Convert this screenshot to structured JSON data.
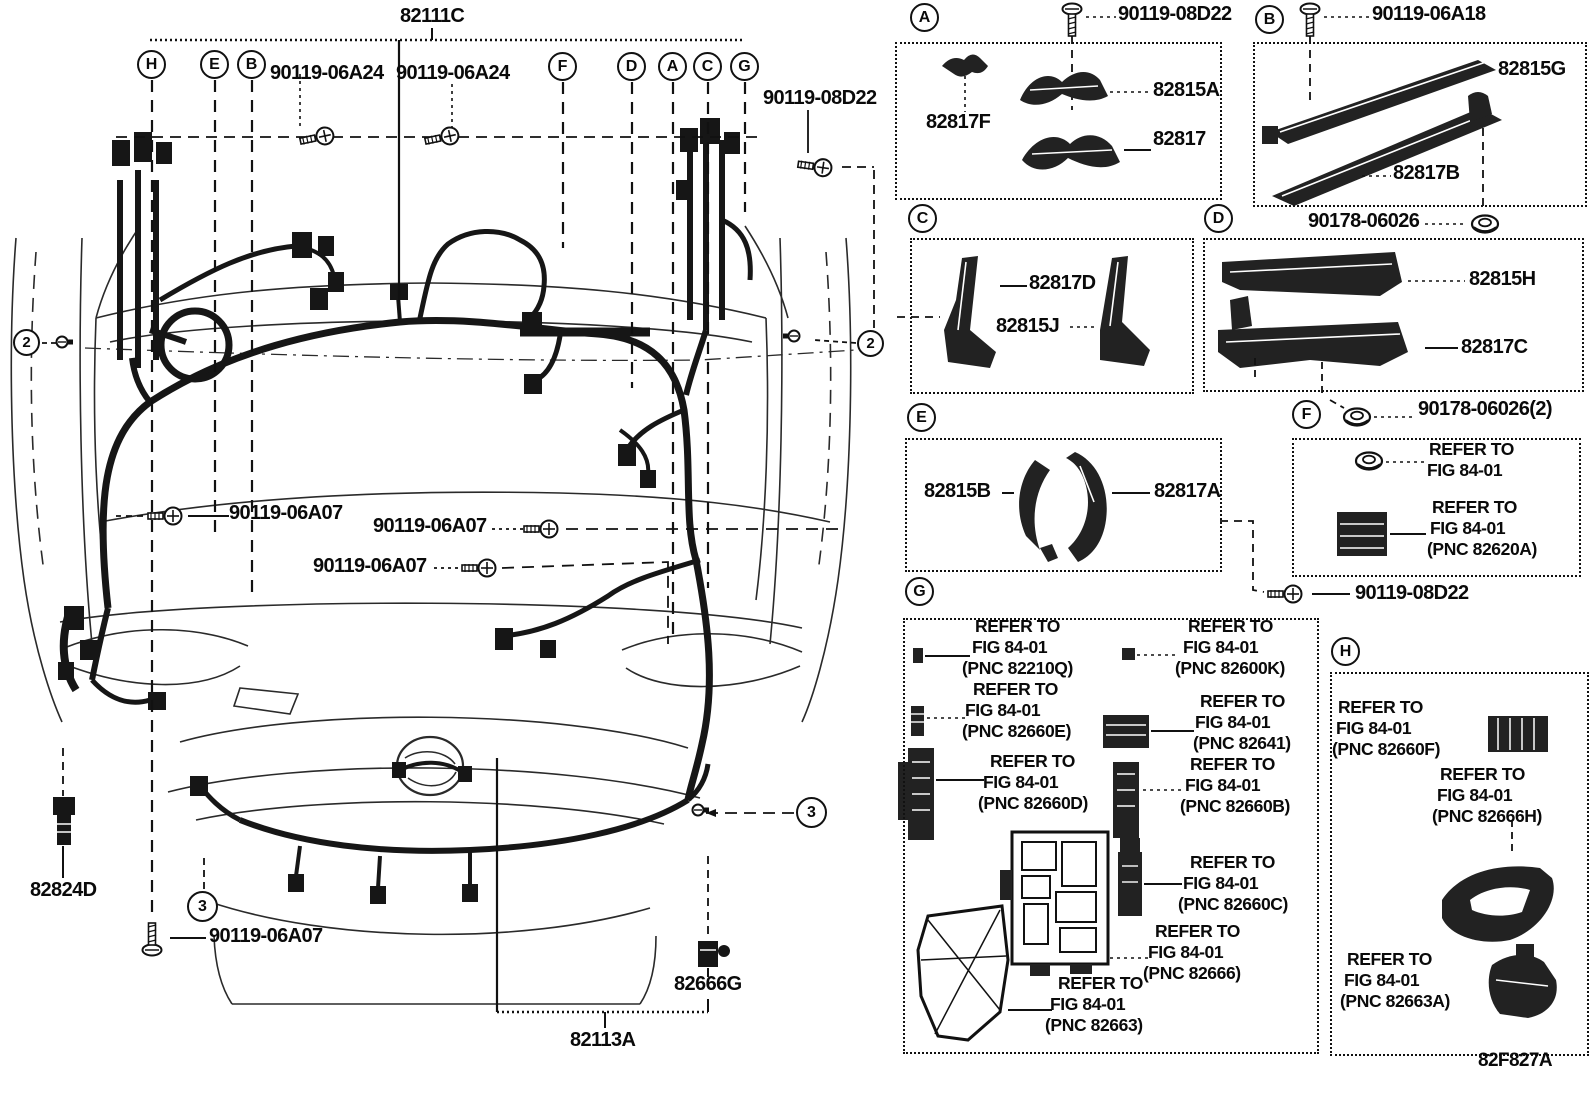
{
  "figure": {
    "code": "82F827A"
  },
  "main": {
    "part_82111C": "82111C",
    "part_82113A": "82113A",
    "part_82666G": "82666G",
    "part_82824D": "82824D",
    "callouts": [
      "H",
      "E",
      "B",
      "F",
      "D",
      "A",
      "C",
      "G"
    ],
    "ref2": "2",
    "ref3": "3",
    "screw_06a24": "90119-06A24",
    "screw_08d22": "90119-08D22",
    "screw_06a07": "90119-06A07"
  },
  "panels": {
    "a": {
      "letter": "A",
      "screw": "90119-08D22",
      "p1": "82817F",
      "p2": "82815A",
      "p3": "82817"
    },
    "b": {
      "letter": "B",
      "screw": "90119-06A18",
      "p1": "82815G",
      "p2": "82817B",
      "nut": "90178-06026"
    },
    "c": {
      "letter": "C",
      "p1": "82817D",
      "p2": "82815J"
    },
    "d": {
      "letter": "D",
      "p1": "82815H",
      "p2": "82817C"
    },
    "e": {
      "letter": "E",
      "p1": "82815B",
      "p2": "82817A"
    },
    "f": {
      "letter": "F",
      "nut": "90178-06026(2)",
      "screw": "90119-08D22",
      "notes": [
        {
          "l1": "REFER TO",
          "l2": "FIG 84-01",
          "l3": ""
        },
        {
          "l1": "REFER TO",
          "l2": "FIG 84-01",
          "l3": "(PNC 82620A)"
        }
      ]
    },
    "g": {
      "letter": "G",
      "notes": [
        {
          "l1": "REFER TO",
          "l2": "FIG 84-01",
          "l3": "(PNC 82210Q)"
        },
        {
          "l1": "REFER TO",
          "l2": "FIG 84-01",
          "l3": "(PNC 82660E)"
        },
        {
          "l1": "REFER TO",
          "l2": "FIG 84-01",
          "l3": "(PNC 82660D)"
        },
        {
          "l1": "REFER TO",
          "l2": "FIG 84-01",
          "l3": "(PNC 82600K)"
        },
        {
          "l1": "REFER TO",
          "l2": "FIG 84-01",
          "l3": "(PNC 82641)"
        },
        {
          "l1": "REFER TO",
          "l2": "FIG 84-01",
          "l3": "(PNC 82660B)"
        },
        {
          "l1": "REFER TO",
          "l2": "FIG 84-01",
          "l3": "(PNC 82660C)"
        },
        {
          "l1": "REFER TO",
          "l2": "FIG 84-01",
          "l3": "(PNC 82666)"
        },
        {
          "l1": "REFER TO",
          "l2": "FIG 84-01",
          "l3": "(PNC 82663)"
        }
      ]
    },
    "h": {
      "letter": "H",
      "notes": [
        {
          "l1": "REFER TO",
          "l2": "FIG 84-01",
          "l3": "(PNC 82660F)"
        },
        {
          "l1": "REFER TO",
          "l2": "FIG 84-01",
          "l3": "(PNC 82666H)"
        },
        {
          "l1": "REFER TO",
          "l2": "FIG 84-01",
          "l3": "(PNC 82663A)"
        }
      ]
    }
  }
}
